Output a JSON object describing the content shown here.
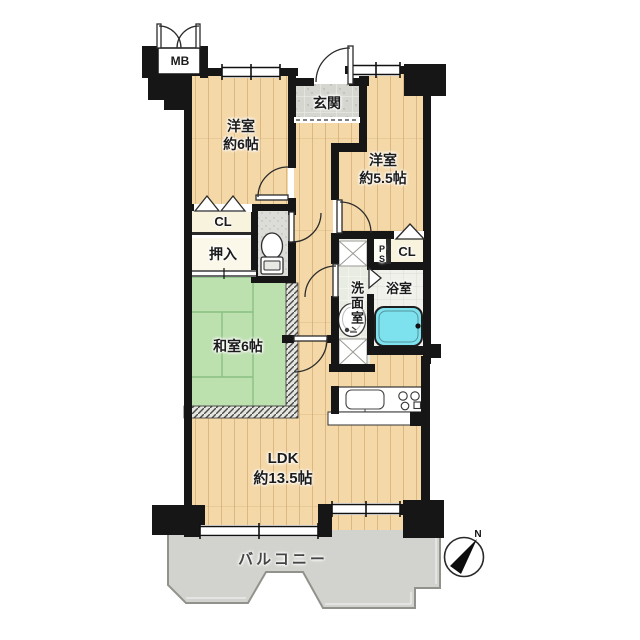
{
  "plan": {
    "meter_box": "MB",
    "entrance": "玄関",
    "western_room_1": {
      "name": "洋室",
      "size": "約6帖"
    },
    "western_room_2": {
      "name": "洋室",
      "size": "約5.5帖"
    },
    "closet_1": "CL",
    "closet_2": "CL",
    "oshiire": "押入",
    "pipe_space": "PS",
    "washroom": "洗面室",
    "bathroom": "浴室",
    "japanese_room": "和室6帖",
    "ldk": {
      "name": "LDK",
      "size": "約13.5帖"
    },
    "balcony": "バルコニー",
    "compass_north": "N"
  },
  "colors": {
    "wall": "#161616",
    "wood_floor": "#F4D8A8",
    "wood_line": "#D3AC74",
    "tatami": "#BDE0AF",
    "tatami_line": "#8AC084",
    "bathtub": "#7EE2EE",
    "balcony": "#D2D3CE",
    "entrance_tile": "#D8D8D3",
    "closet_cream": "#F7F3DD"
  }
}
